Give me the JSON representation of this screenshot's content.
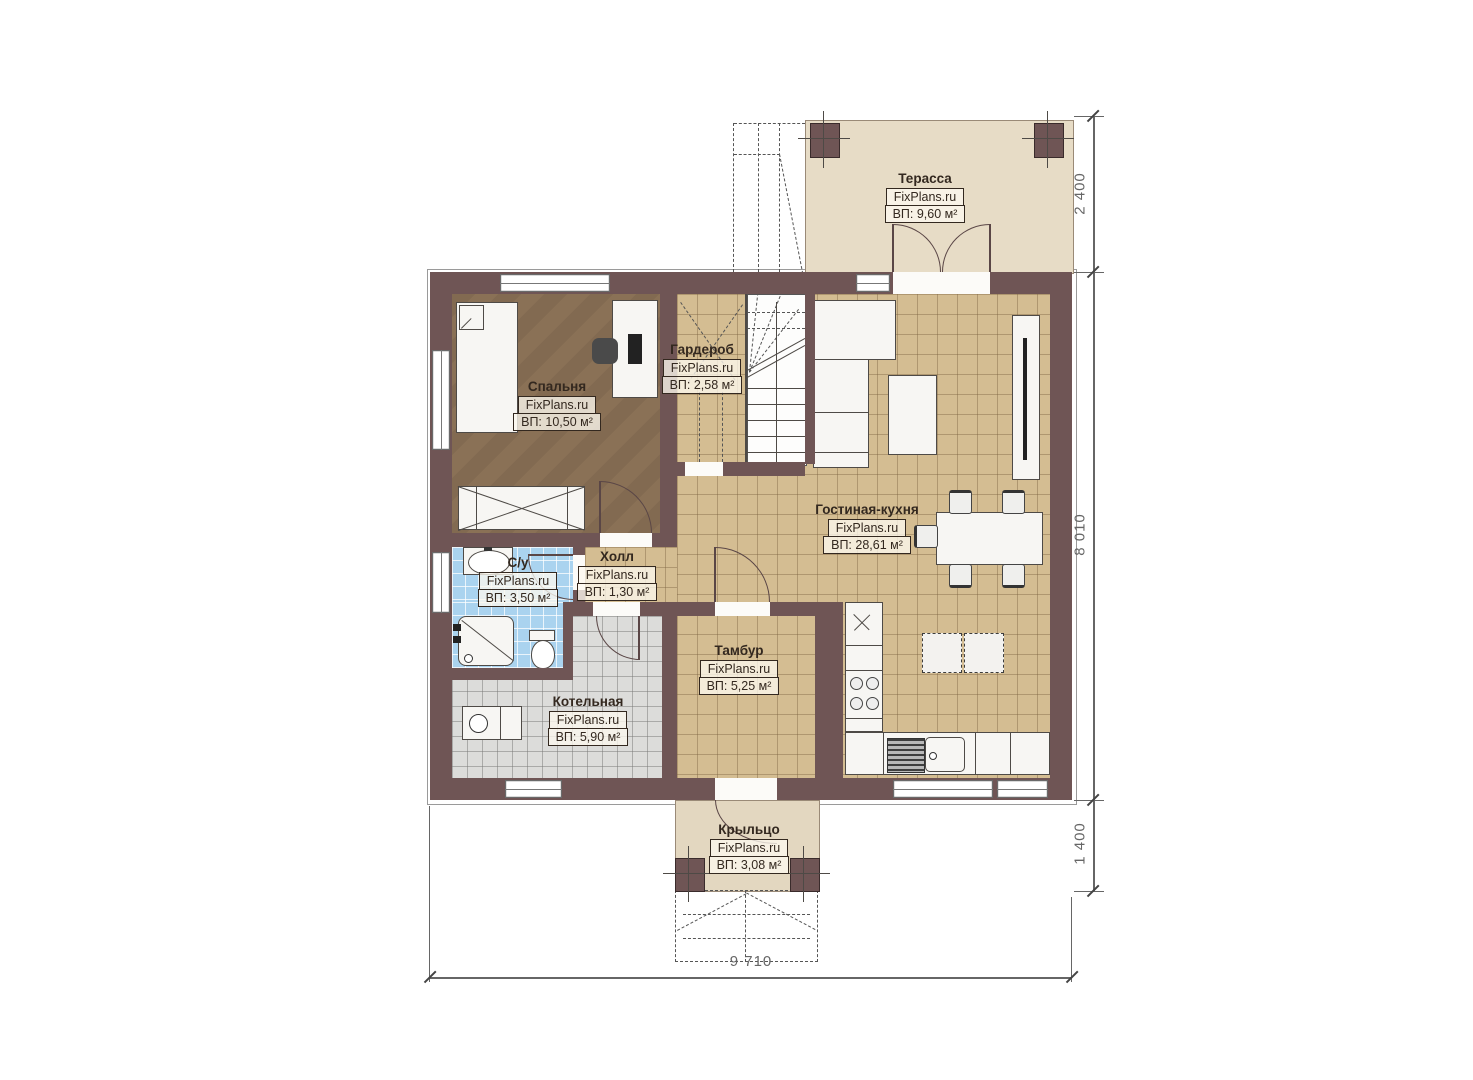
{
  "brand": "FixPlans.ru",
  "rooms": {
    "terrace": {
      "name": "Терасса",
      "area": "ВП: 9,60 м²"
    },
    "bedroom": {
      "name": "Спальня",
      "area": "ВП: 10,50 м²"
    },
    "wardrobe": {
      "name": "Гардероб",
      "area": "ВП: 2,58 м²"
    },
    "living_kitchen": {
      "name": "Гостиная-кухня",
      "area": "ВП: 28,61 м²"
    },
    "hall": {
      "name": "Холл",
      "area": "ВП: 1,30 м²"
    },
    "bathroom": {
      "name": "С/у",
      "area": "ВП: 3,50 м²"
    },
    "vestibule": {
      "name": "Тамбур",
      "area": "ВП: 5,25 м²"
    },
    "boiler": {
      "name": "Котельная",
      "area": "ВП: 5,90 м²"
    },
    "porch": {
      "name": "Крыльцо",
      "area": "ВП: 3,08 м²"
    }
  },
  "dimensions": {
    "terrace_depth": "2 400",
    "house_depth": "8 010",
    "porch_depth": "1 400",
    "total_width": "9 710"
  },
  "colors": {
    "wall": "#6f5555",
    "tile_tan": "#d4bd92",
    "bedroom_floor": "#8a7156",
    "bathroom_tile": "#aad3ef",
    "boiler_tile": "#dcdcda",
    "terrace_floor": "#e7dcc6",
    "porch_floor": "#e3d7c0"
  }
}
